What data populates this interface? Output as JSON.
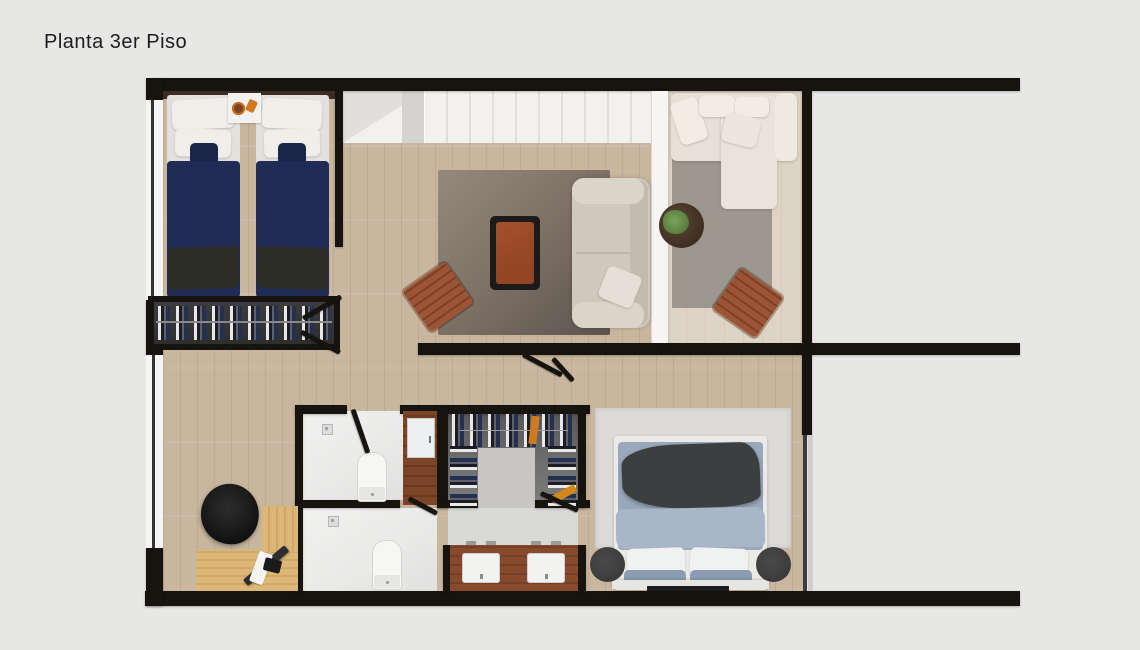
{
  "page": {
    "title": "Planta 3er Piso",
    "background": "#e7e7e6"
  },
  "palette": {
    "bg": "#e7e7e6",
    "wall": "#17130f",
    "white-trim": "#f6f5f3",
    "wood": "#c9b69e",
    "wood-light": "#ded4c5",
    "stairs": "#f2f1ef",
    "bath": "#e9e9e8",
    "rug-living-a": "#96887c",
    "rug-living-b": "#5c534c",
    "rug-lounge": "#9d988f",
    "rug-bedroom": "#dcdbd8",
    "sofa": "#cfc9bd",
    "sectional": "#e6e1d7",
    "navy": "#202c55",
    "throw-dark": "#2b2d26",
    "duvet": "#9aa8bd",
    "duvet-light": "#a9b6c7",
    "accent-wood": "#9c5436",
    "leather": "#934526",
    "vanity": "#874a2c",
    "door-brown": "#7c4527",
    "desk": "#dcb777",
    "closet-bg": "#2e2e2e",
    "closet-floor": "#6f6f6f",
    "plant": "#5d8040",
    "pouf": "#3b3b3b",
    "orange": "#cf7a1e"
  }
}
